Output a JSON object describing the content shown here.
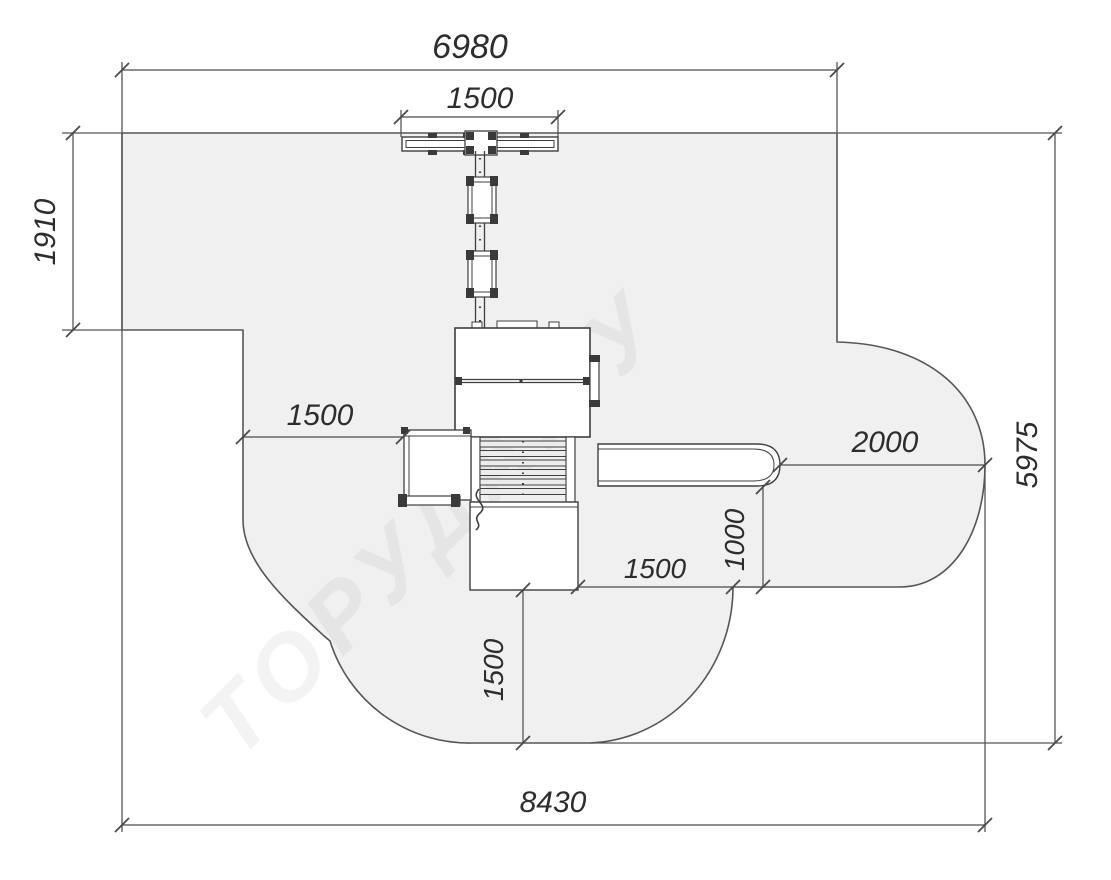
{
  "drawing": {
    "watermark": "ТОРУДА.РУ",
    "colors": {
      "zone_fill": "#f0f0f0",
      "zone_stroke": "#565656",
      "equipment_stroke": "#3f3f3f",
      "dimension_line": "#4a4a4a",
      "dimension_text": "#2d2d2d",
      "background": "#ffffff"
    },
    "dims": {
      "top_total": "6980",
      "swing_beam": "1500",
      "upper_left_height": "1910",
      "left_clearance": "1500",
      "slide_runout": "2000",
      "right_height": "5975",
      "exit_depth": "1000",
      "mid_clearance": "1500",
      "bottom_clearance": "1500",
      "bottom_total": "8430"
    }
  }
}
